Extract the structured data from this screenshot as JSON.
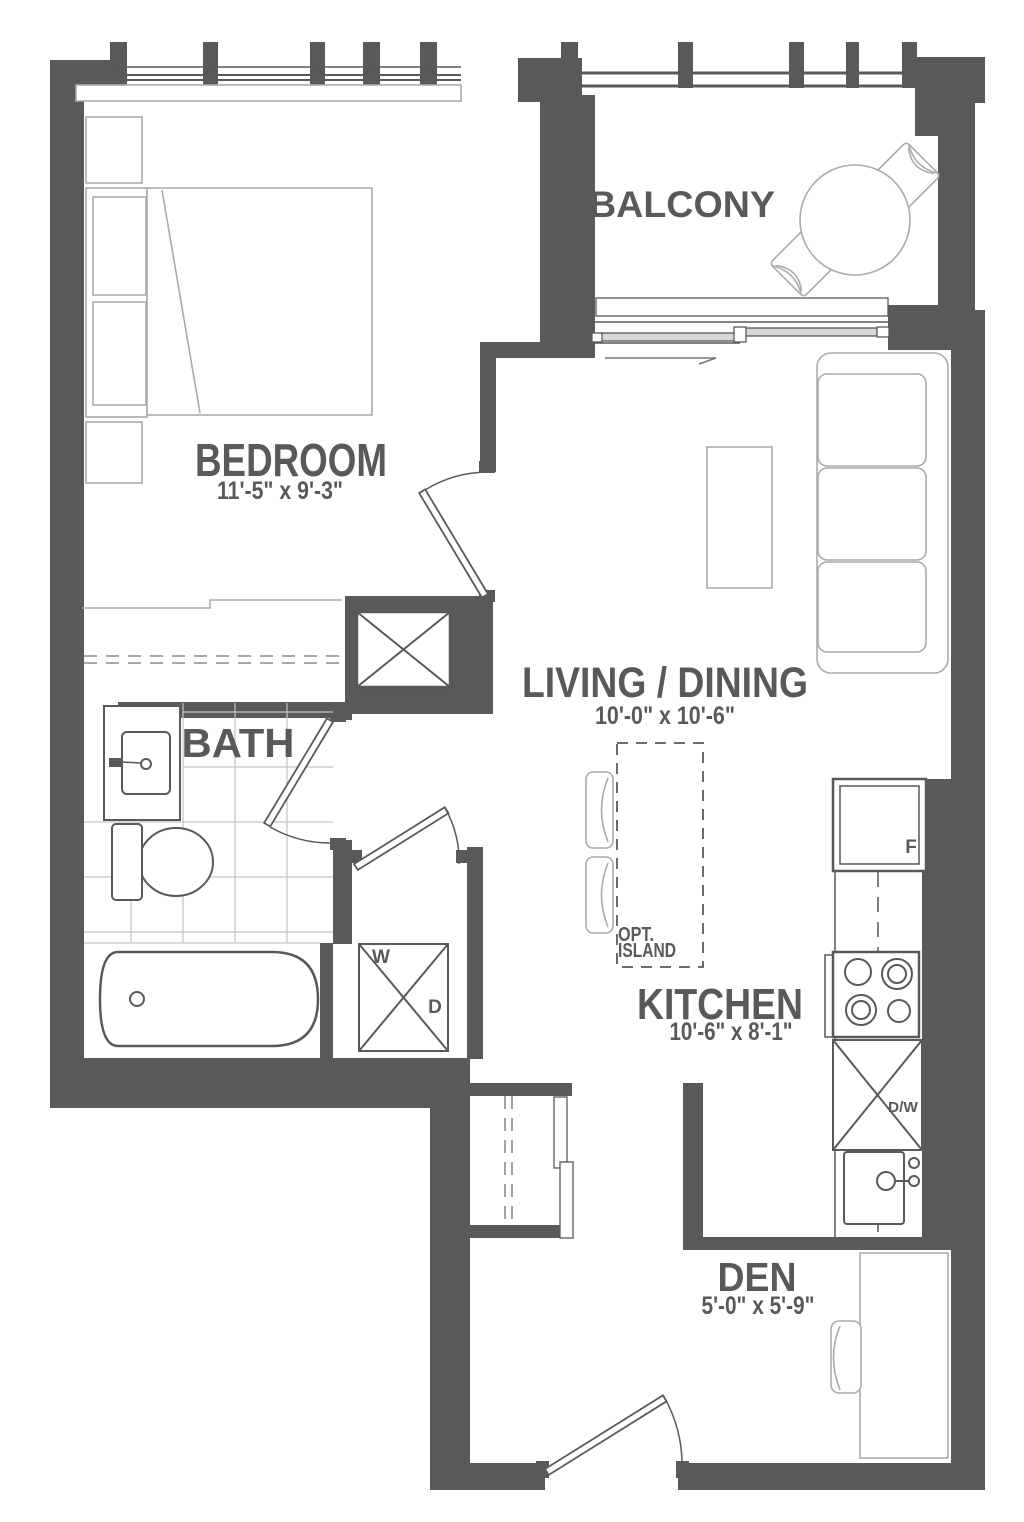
{
  "plan": {
    "rooms": [
      {
        "name": "BALCONY",
        "dims": ""
      },
      {
        "name": "BEDROOM",
        "dims": "11'-5\" x 9'-3\""
      },
      {
        "name": "LIVING / DINING",
        "dims": "10'-0\" x 10'-6\""
      },
      {
        "name": "BATH",
        "dims": ""
      },
      {
        "name": "KITCHEN",
        "dims": "10'-6\" x 8'-1\""
      },
      {
        "name": "DEN",
        "dims": "5'-0\" x 5'-9\""
      }
    ],
    "appliances": {
      "fridge": "F",
      "dishwasher": "D/W",
      "washer": "W",
      "dryer": "D"
    },
    "island": {
      "line1": "OPT.",
      "line2": "ISLAND"
    },
    "colors": {
      "wall": "#58595B",
      "text": "#58595B",
      "furniture_line": "#ABABAB",
      "fixture_line": "#58595B",
      "background": "#FFFFFF"
    }
  }
}
